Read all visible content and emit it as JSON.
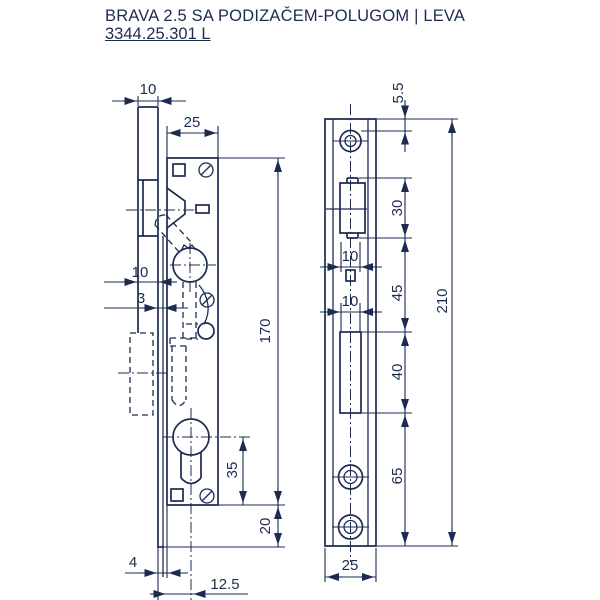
{
  "title": {
    "line1": "BRAVA 2.5 SA PODIZAČEM-POLUGOM | LEVA",
    "line2": "3344.25.301 L"
  },
  "colors": {
    "ink": "#1c2b50",
    "background": "#ffffff"
  },
  "side_view": {
    "label": "lock-body-side-view",
    "dims": {
      "faceplate_width_top": "10",
      "case_depth": "25",
      "case_length": "170",
      "mid_width": "10",
      "plate_thickness": "3",
      "cylinder_to_bottom": "35",
      "plate_below_case": "20",
      "edge_gap": "4",
      "backset": "12.5"
    }
  },
  "front_view": {
    "label": "faceplate-front-view",
    "dims": {
      "end_to_hole": "5.5",
      "latch_cutout_length": "30",
      "cutout_width_upper": "10",
      "upper_spacing": "45",
      "cutout_width_lower": "10",
      "total_length": "210",
      "hook_cutout_length": "40",
      "bottom_section": "65",
      "plate_width": "25"
    }
  }
}
